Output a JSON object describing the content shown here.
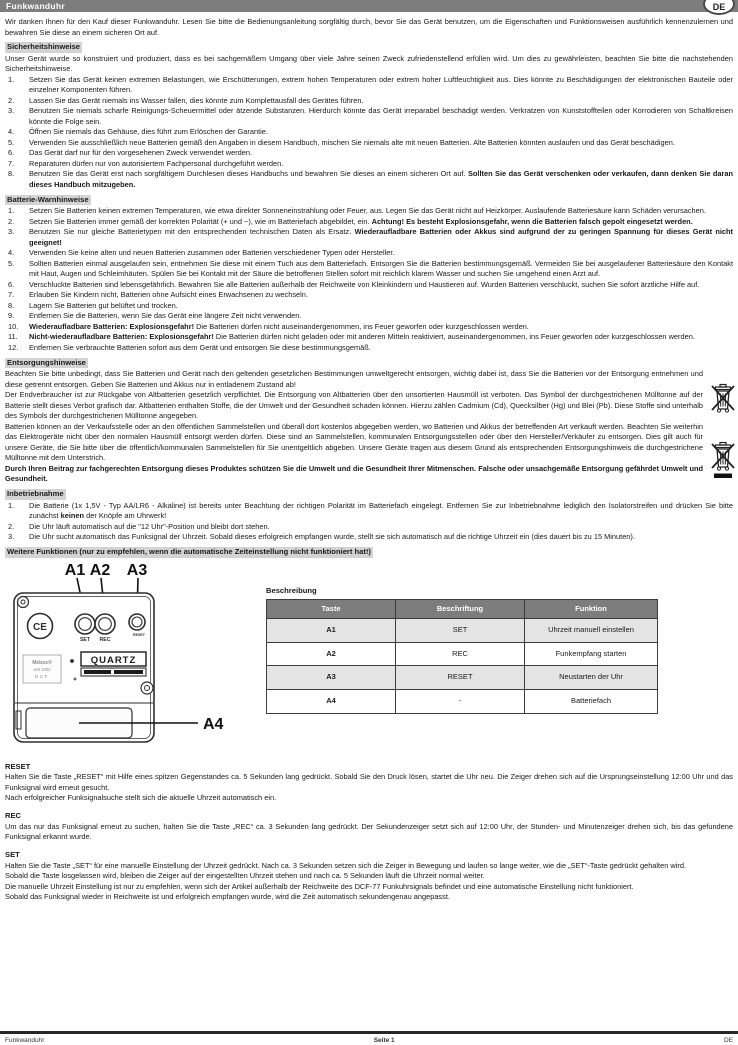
{
  "header": {
    "title": "Funkwanduhr",
    "lang_badge": "DE"
  },
  "intro": "Wir danken Ihnen für den Kauf dieser Funkwanduhr. Lesen Sie bitte die Bedienungsanleitung sorgfältig durch, bevor Sie das Gerät benutzen, um die Eigenschaften und Funktionsweisen ausführlich kennenzulernen und bewahren Sie diese an einem sicheren Ort auf.",
  "safety": {
    "heading": "Sicherheitshinweise",
    "intro": "Unser Gerät wurde so konstruiert und produziert, dass es bei sachgemäßem Umgang über viele Jahre seinen Zweck zufriedenstellend erfüllen wird. Um dies zu gewährleisten, beachten Sie bitte die nachstehenden Sicherheitshinweise.",
    "items": [
      [
        {
          "t": "Setzen Sie das Gerät keinen extremen Belastungen, wie Erschütterungen, extrem hohen Temperaturen oder extrem hoher Luftfeuchtigkeit aus. Dies könnte zu Beschädigungen der elektronischen Bauteile oder einzelner Komponenten führen.",
          "b": false
        }
      ],
      [
        {
          "t": "Lassen Sie das Gerät niemals ins Wasser fallen, dies könnte zum Komplettausfall des Gerätes führen.",
          "b": false
        }
      ],
      [
        {
          "t": "Benutzen Sie niemals scharfe Reinigungs-Scheuermittel oder ätzende Substanzen. Hierdurch könnte das Gerät irreparabel beschädigt werden. Verkratzen von Kunststoffteilen oder Korrodieren von Schaltkreisen könnte die Folge sein.",
          "b": false
        }
      ],
      [
        {
          "t": "Öffnen Sie niemals das Gehäuse, dies führt zum Erlöschen der Garantie.",
          "b": false
        }
      ],
      [
        {
          "t": "Verwenden Sie ausschließlich neue Batterien gemäß den Angaben in diesem Handbuch, mischen Sie niemals alte mit neuen Batterien. Alte Batterien könnten auslaufen und das Gerät beschädigen.",
          "b": false
        }
      ],
      [
        {
          "t": "Das Gerät darf nur für den vorgesehenen Zweck verwendet werden.",
          "b": false
        }
      ],
      [
        {
          "t": "Reparaturen dürfen nur von autorisiertem Fachpersonal durchgeführt werden.",
          "b": false
        }
      ],
      [
        {
          "t": "Benutzen Sie das Gerät erst nach sorgfältigem Durchlesen dieses Handbuchs und bewahren Sie dieses an einem sicheren Ort auf. ",
          "b": false
        },
        {
          "t": "Sollten Sie das Gerät verschenken oder verkaufen, dann denken Sie daran dieses Handbuch mitzugeben.",
          "b": true
        }
      ]
    ]
  },
  "battery": {
    "heading": "Batterie-Warnhinweise",
    "items": [
      [
        {
          "t": "Setzen Sie Batterien keinen extremen Temperaturen, wie etwa direkter Sonneneinstrahlung oder Feuer, aus. Legen Sie das Gerät nicht auf Heizkörper. Auslaufende Batteriesäure kann Schäden verursachen.",
          "b": false
        }
      ],
      [
        {
          "t": "Setzen Sie Batterien immer gemäß der korrekten Polarität (+ und −), wie im Batteriefach abgebildet, ein. ",
          "b": false
        },
        {
          "t": "Achtung! Es besteht Explosionsgefahr, wenn die Batterien falsch gepolt eingesetzt werden.",
          "b": true
        }
      ],
      [
        {
          "t": "Benutzen Sie nur gleiche Batterietypen mit den entsprechenden technischen Daten als Ersatz. ",
          "b": false
        },
        {
          "t": "Wiederaufladbare Batterien oder Akkus sind aufgrund der zu geringen Spannung für dieses Gerät nicht geeignet!",
          "b": true
        }
      ],
      [
        {
          "t": "Verwenden Sie keine alten und neuen Batterien zusammen oder Batterien verschiedener Typen oder Hersteller.",
          "b": false
        }
      ],
      [
        {
          "t": "Sollten Batterien einmal ausgelaufen sein, entnehmen Sie diese mit einem Tuch aus dem Batteriefach. Entsorgen Sie die Batterien bestimmungsgemäß. Vermeiden Sie bei ausgelaufener Batteriesäure den Kontakt mit Haut, Augen und Schleimhäuten. Spülen Sie bei Kontakt mit der Säure die betroffenen Stellen sofort mit reichlich klarem Wasser und suchen Sie umgehend einen Arzt auf.",
          "b": false
        }
      ],
      [
        {
          "t": "Verschluckte Batterien sind lebensgefährlich. Bewahren Sie alle Batterien außerhalb der Reichweite von Kleinkindern und Haustieren auf. Wurden Batterien verschluckt, suchen Sie sofort ärztliche Hilfe auf.",
          "b": false
        }
      ],
      [
        {
          "t": "Erlauben Sie Kindern nicht, Batterien ohne Aufsicht eines Erwachsenen zu wechseln.",
          "b": false
        }
      ],
      [
        {
          "t": "Lagern Sie Batterien gut belüftet und trocken.",
          "b": false
        }
      ],
      [
        {
          "t": "Entfernen Sie die Batterien, wenn Sie das Gerät eine längere Zeit nicht verwenden.",
          "b": false
        }
      ],
      [
        {
          "t": "Wiederaufladbare Batterien: Explosionsgefahr!",
          "b": true
        },
        {
          "t": " Die Batterien dürfen nicht auseinandergenommen, ins Feuer geworfen oder kurzgeschlossen werden.",
          "b": false
        }
      ],
      [
        {
          "t": "Nicht-wiederaufladbare Batterien: Explosionsgefahr!",
          "b": true
        },
        {
          "t": " Die Batterien dürfen nicht geladen oder mit anderen Mitteln reaktiviert, auseinandergenommen, ins Feuer geworfen oder kurzgeschlossen werden.",
          "b": false
        }
      ],
      [
        {
          "t": "Entfernen Sie verbrauchte Batterien sofort aus dem Gerät und entsorgen Sie diese bestimmungsgemäß.",
          "b": false
        }
      ]
    ]
  },
  "disposal": {
    "heading": "Entsorgungshinweise",
    "paragraphs": [
      [
        {
          "t": "Beachten Sie bitte unbedingt, dass Sie Batterien und Gerät nach den geltenden gesetzlichen Bestimmungen umweltgerecht entsorgen, wichtig dabei ist, dass Sie die Batterien vor der Entsorgung entnehmen und diese getrennt entsorgen. Geben Sie Batterien und Akkus nur in entladenem Zustand ab!",
          "b": false
        }
      ],
      [
        {
          "t": "Der Endverbraucher ist zur Rückgabe von Altbatterien gesetzlich verpflichtet. Die Entsorgung von Altbatterien über den unsortierten Hausmüll ist verboten. Das Symbol der durchgestrichenen Mülltonne auf der Batterie stellt dieses Verbot grafisch dar. Altbatterien enthalten Stoffe, die der Umwelt und der Gesundheit schaden können. Hierzu zählen Cadmium (Cd), Quecksilber (Hg) und Blei (Pb). Diese Stoffe sind unterhalb des Symbols der durchgestrichenen Mülltonne angegeben.",
          "b": false
        }
      ],
      [
        {
          "t": "Batterien können an der Verkaufsstelle oder an den öffentlichen Sammelstellen und überall dort kostenlos abgegeben werden, wo Batterien und Akkus der betreffenden Art verkauft werden. Beachten Sie weiterhin das Elektrogeräte nicht über den normalen Hausmüll entsorgt werden dürfen. Diese sind an Sammelstellen, kommunalen Entsorgungsstellen oder über den Hersteller/Verkäufer zu entsorgen. Dies gilt auch für unsere Geräte, die Sie bitte über die öffentlich/kommunalen Sammelstellen für Sie unentgeltlich abgeben. Unsere Geräte tragen aus diesem Grund als entsprechenden Entsorgungshinweis die durchgestrichene Mülltonne mit dem Unterstrich.",
          "b": false
        }
      ],
      [
        {
          "t": "Durch Ihren Beitrag zur fachgerechten Entsorgung dieses Produktes schützen Sie die Umwelt und die Gesundheit Ihrer Mitmenschen. Falsche oder unsachgemäße Entsorgung gefährdet Umwelt und Gesundheit.",
          "b": true
        }
      ]
    ]
  },
  "setup": {
    "heading": "Inbetriebnahme",
    "items": [
      [
        {
          "t": "Die Batterie (1x 1,5V - Typ AA/LR6 - Alkaline) ist bereits unter Beachtung der richtigen Polarität im Batteriefach eingelegt. Entfernen Sie zur Inbetriebnahme lediglich den Isolatorstreifen und drücken Sie bitte zunächst ",
          "b": false
        },
        {
          "t": "keinen",
          "b": true
        },
        {
          "t": " der Knöpfe am Uhrwerk!",
          "b": false
        }
      ],
      [
        {
          "t": "Die Uhr läuft automatisch auf die \"12 Uhr\"-Position und bleibt dort stehen.",
          "b": false
        }
      ],
      [
        {
          "t": "Die Uhr sucht automatisch das Funksignal der Uhrzeit. Sobald dieses erfolgreich empfangen wurde, stellt sie sich automatisch auf die richtige Uhrzeit ein (dies dauert bis zu 15 Minuten).",
          "b": false
        }
      ]
    ]
  },
  "more_functions_heading": "Weitere Funktionen (nur zu empfehlen, wenn die automatische Zeiteinstellung nicht funktioniert hat!)",
  "device": {
    "label_a1": "A1",
    "label_a2": "A2",
    "label_a3": "A3",
    "label_a4": "A4",
    "button_set": "SET",
    "button_rec": "REC",
    "button_reset": "RESET",
    "ce_mark": "CE",
    "brand_line1": "Mebus®",
    "brand_line2": "seit 1902",
    "brand_line3": "DCF",
    "quartz_label": "QUARTZ"
  },
  "table": {
    "caption": "Beschreibung",
    "headers": [
      "Taste",
      "Beschriftung",
      "Funktion"
    ],
    "rows": [
      [
        "A1",
        "SET",
        "Uhrzeit manuell einstellen"
      ],
      [
        "A2",
        "REC",
        "Funkempfang starten"
      ],
      [
        "A3",
        "RESET",
        "Neustarten der Uhr"
      ],
      [
        "A4",
        "-",
        "Batteriefach"
      ]
    ]
  },
  "procedures": [
    {
      "heading": "RESET",
      "paragraphs": [
        "Halten Sie die Taste „RESET“ mit Hilfe eines spitzen Gegenstandes ca. 5 Sekunden lang gedrückt. Sobald Sie den Druck lösen, startet die Uhr neu. Die Zeiger drehen sich auf die Ursprungseinstellung 12:00 Uhr und das Funksignal wird erneut gesucht.",
        "Nach erfolgreicher Funksignalsuche stellt sich die aktuelle Uhrzeit automatisch ein."
      ]
    },
    {
      "heading": "REC",
      "paragraphs": [
        "Um das nur das Funksignal erneut zu suchen, halten Sie die Taste „REC“ ca. 3 Sekunden lang gedrückt. Der Sekundenzeiger setzt sich auf 12:00 Uhr, der Stunden- und Minutenzeiger drehen sich, bis das gefundene Funksignal erkannt wurde."
      ]
    },
    {
      "heading": "SET",
      "paragraphs": [
        "Halten Sie die Taste „SET“ für eine manuelle Einstellung der Uhrzeit gedrückt. Nach ca. 3 Sekunden setzen sich die Zeiger in Bewegung und laufen so lange weiter, wie die „SET“-Taste gedrückt gehalten wird.",
        "Sobald die Taste losgelassen wird, bleiben die Zeiger auf der eingestellten Uhrzeit stehen und nach ca. 5 Sekunden läuft die Uhrzeit normal weiter.",
        "Die manuelle Uhrzeit Einstellung ist nur zu empfehlen, wenn sich der Artikel außerhalb der Reichweite des DCF-77 Funkuhrsignals befindet und eine automatische Einstellung nicht funktioniert.",
        "Sobald das Funksignal wieder in Reichweite ist und erfolgreich empfangen wurde, wird die Zeit automatisch sekundengenau angepasst."
      ]
    }
  ],
  "footer": {
    "left": "Funkwanduhr",
    "center": "Seite 1",
    "right": "DE"
  },
  "colors": {
    "header_bar": "#7d7d7d",
    "heading_highlight": "#d3d3d3",
    "table_header": "#7d7d7d",
    "alt_row": "#e4e4e4"
  }
}
